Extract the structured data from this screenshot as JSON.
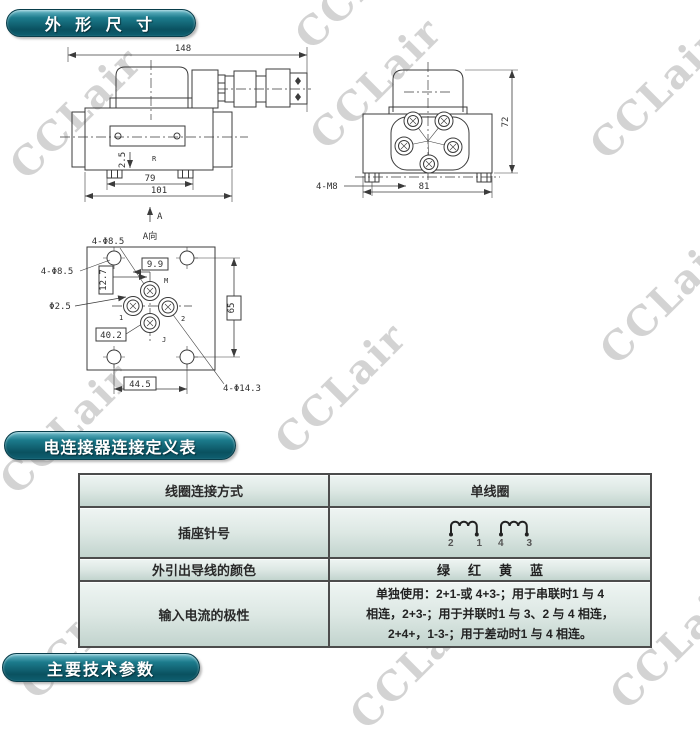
{
  "banners": {
    "outline_dims": "外 形 尺 寸",
    "connector_table": "电连接器连接定义表",
    "main_params": "主要技术参数"
  },
  "watermark": {
    "text": "CCLair",
    "positions": [
      [
        65,
        115
      ],
      [
        365,
        85
      ],
      [
        645,
        95
      ],
      [
        350,
        -15
      ],
      [
        55,
        430
      ],
      [
        330,
        390
      ],
      [
        655,
        300
      ],
      [
        75,
        635
      ],
      [
        405,
        665
      ],
      [
        665,
        645
      ]
    ]
  },
  "side_view": {
    "dim_148": "148",
    "dim_79": "79",
    "dim_101": "101",
    "dim_2_5": "2.5",
    "mark": "R",
    "view_label": "A"
  },
  "end_view": {
    "dim_72": "72",
    "dim_81": "81",
    "thread_label": "4-M8"
  },
  "bottom_view": {
    "title": "A向",
    "hole_label_top": "4-Φ8.5",
    "hole_label_left": "4-Φ8.5",
    "pin_label": "Φ2.5",
    "dim_9_9": "9.9",
    "dim_12_7": "12.7",
    "dim_40_2": "40.2",
    "dim_44_5": "44.5",
    "dim_65": "65",
    "hole_label_br": "4-Φ14.3",
    "port_top": "M",
    "port_left": "1",
    "port_right": "2",
    "port_bottom": "J"
  },
  "table": {
    "row1": {
      "label": "线圈连接方式",
      "value": "单线圈"
    },
    "row2": {
      "label": "插座针号",
      "pins": [
        "2",
        "1",
        "4",
        "3"
      ]
    },
    "row3": {
      "label": "外引出导线的颜色",
      "colors": [
        "绿",
        "红",
        "黄",
        "蓝"
      ]
    },
    "row4": {
      "label": "输入电流的极性",
      "line1": "单独使用：2+1-或 4+3-；用于串联时1 与 4",
      "line2": "相连，2+3-；用于并联时1 与 3、2 与 4 相连，",
      "line3": "2+4+，1-3-；用于差动时1 与 4 相连。"
    }
  }
}
